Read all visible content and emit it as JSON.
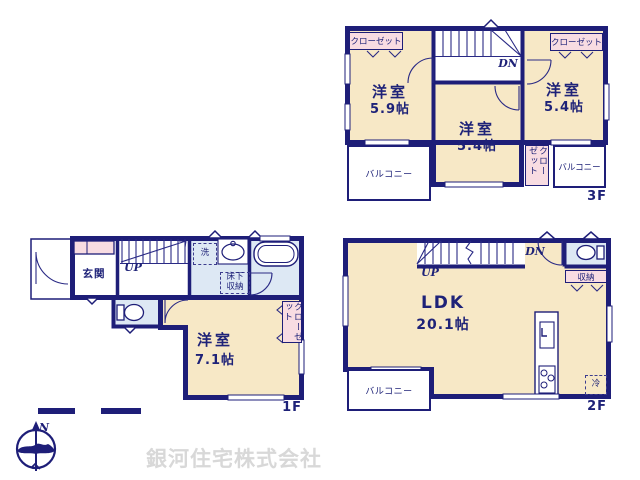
{
  "company_name": "銀河住宅株式会社",
  "compass_north": "N",
  "floor3": {
    "label": "3F",
    "closet_left": "クローゼット",
    "closet_right": "クローゼット",
    "closet_center": "クローゼット",
    "room_left_name": "洋室",
    "room_left_size": "5.9帖",
    "room_center_name": "洋室",
    "room_center_size": "5.4帖",
    "room_right_name": "洋室",
    "room_right_size": "5.4帖",
    "balcony_left": "バルコニー",
    "balcony_right": "バルコニー",
    "stairs_down": "DN"
  },
  "floor2": {
    "label": "2F",
    "stairs_up": "UP",
    "stairs_down": "DN",
    "ldk_name": "LDK",
    "ldk_size": "20.1帖",
    "storage": "収納",
    "balcony": "バルコニー",
    "fridge": "冷"
  },
  "floor1": {
    "label": "1F",
    "entrance": "玄関",
    "stairs_up": "UP",
    "laundry": "洗",
    "underfloor_storage": "床下収納",
    "room_name": "洋室",
    "room_size": "7.1帖",
    "closet": "クローゼット"
  }
}
